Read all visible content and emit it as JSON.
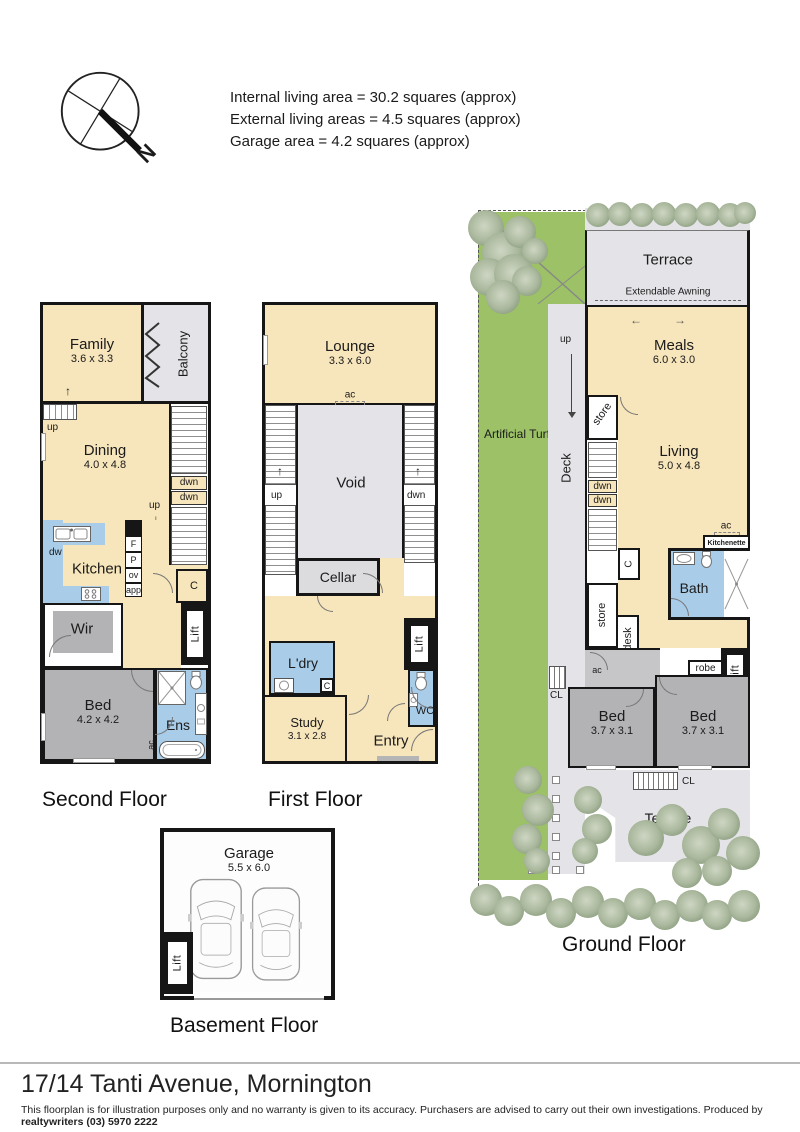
{
  "header": {
    "compass_n": "N",
    "areas": [
      "Internal living area = 30.2 squares (approx)",
      "External living areas = 4.5 squares (approx)",
      "Garage area = 4.2 squares (approx)"
    ]
  },
  "labels": {
    "up": "up",
    "dwn": "dwn",
    "ac": "ac",
    "c": "C",
    "cl": "CL",
    "lift": "Lift",
    "dw": "dw",
    "f": "F",
    "p": "P",
    "ov": "ov",
    "app": "app",
    "store": "store"
  },
  "floors": {
    "second": {
      "title": "Second Floor",
      "rooms": {
        "family": {
          "name": "Family",
          "dims": "3.6 x 3.3"
        },
        "balcony": {
          "name": "Balcony"
        },
        "dining": {
          "name": "Dining",
          "dims": "4.0 x 4.8"
        },
        "kitchen": {
          "name": "Kitchen"
        },
        "wir": {
          "name": "Wir"
        },
        "bed": {
          "name": "Bed",
          "dims": "4.2 x 4.2"
        },
        "ens": {
          "name": "Ens"
        }
      }
    },
    "first": {
      "title": "First Floor",
      "rooms": {
        "lounge": {
          "name": "Lounge",
          "dims": "3.3 x 6.0"
        },
        "void": {
          "name": "Void"
        },
        "cellar": {
          "name": "Cellar"
        },
        "laundry": {
          "name": "L'dry"
        },
        "wc": {
          "name": "WC"
        },
        "study": {
          "name": "Study",
          "dims": "3.1 x 2.8"
        },
        "entry": {
          "name": "Entry"
        }
      }
    },
    "ground": {
      "title": "Ground Floor",
      "rooms": {
        "terrace_top": {
          "name": "Terrace"
        },
        "awning": {
          "name": "Extendable Awning"
        },
        "meals": {
          "name": "Meals",
          "dims": "6.0 x 3.0"
        },
        "turf": {
          "name": "Artificial Turf"
        },
        "deck": {
          "name": "Deck"
        },
        "living": {
          "name": "Living",
          "dims": "5.0 x 4.8"
        },
        "kitchenette": {
          "name": "Kitchenette"
        },
        "bath": {
          "name": "Bath"
        },
        "desk": {
          "name": "desk"
        },
        "robe": {
          "name": "robe"
        },
        "bed_left": {
          "name": "Bed",
          "dims": "3.7 x 3.1"
        },
        "bed_right": {
          "name": "Bed",
          "dims": "3.7 x 3.1"
        },
        "terrace_bottom": {
          "name": "Terrace"
        }
      }
    },
    "basement": {
      "title": "Basement Floor",
      "rooms": {
        "garage": {
          "name": "Garage",
          "dims": "5.5 x 6.0"
        }
      }
    }
  },
  "footer": {
    "address": "17/14 Tanti Avenue, Mornington",
    "disclaimer": "This floorplan is for illustration purposes only and no warranty is given to its accuracy. Purchasers are advised to carry out their own investigations. Produced by ",
    "producer": "realtywriters (03) 5970 2222"
  },
  "colors": {
    "cream": "#F7E5BB",
    "wet_blue": "#A9CCE9",
    "room_gray": "#B3B3B6",
    "outdoor_gray": "#E4E4E8",
    "turf_green": "#9CC167",
    "wall": "#161616"
  }
}
